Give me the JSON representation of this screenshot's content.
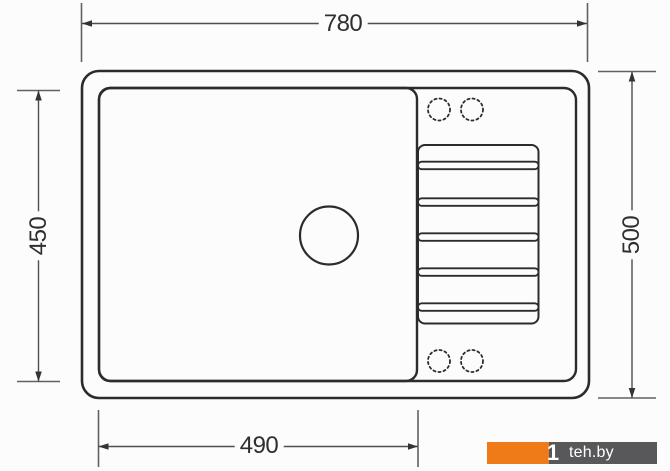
{
  "drawing": {
    "type": "technical-drawing",
    "subject": "kitchen sink with drainboard, top view",
    "dimensions": {
      "top": {
        "value": "780",
        "orientation": "horizontal",
        "measures": "overall width"
      },
      "right": {
        "value": "500",
        "orientation": "vertical",
        "measures": "overall depth"
      },
      "left": {
        "value": "450",
        "orientation": "vertical",
        "measures": "bowl depth"
      },
      "bottom": {
        "value": "490",
        "orientation": "horizontal",
        "measures": "bowl width"
      }
    },
    "features": {
      "bowl": 1,
      "drain_hole": 1,
      "drainboard_grooves": 5,
      "tap_hole_markings": 4
    }
  },
  "watermark": {
    "logo_glyph": "1",
    "text": "teh.by"
  },
  "colors": {
    "outline": "#2c2c2c",
    "dimension_line": "#4f4f4f",
    "extension_line": "#616161",
    "arrow": "#333333",
    "label_text": "#2f2f2f",
    "background": "#fcfcfc",
    "watermark_orange": "#ee7b17",
    "watermark_gray": "#58585a",
    "watermark_text": "#ffffff"
  }
}
